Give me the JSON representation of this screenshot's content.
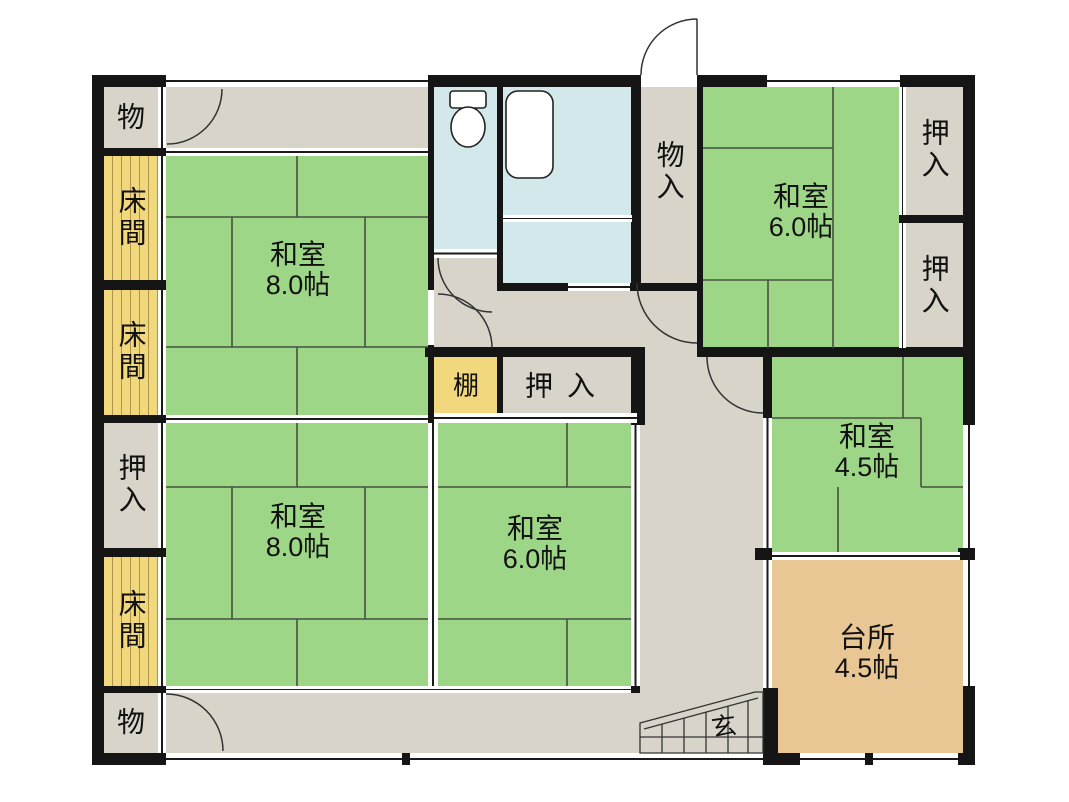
{
  "plan": {
    "type": "japanese-house-floor-plan",
    "colors": {
      "tatami_green": "#9ed687",
      "hall_gray": "#d8d4c9",
      "tokonoma_yellow": "#f2d87c",
      "wet_area_blue": "#d2e8ea",
      "kitchen_tan": "#e9c795",
      "wall_black": "#151515"
    },
    "rooms": [
      {
        "id": "storage-top-left",
        "label": "物"
      },
      {
        "id": "tokonoma-upper-1",
        "label": "床間"
      },
      {
        "id": "tokonoma-upper-2",
        "label": "床間"
      },
      {
        "id": "closet-left",
        "label": "押入"
      },
      {
        "id": "tokonoma-lower",
        "label": "床間"
      },
      {
        "id": "storage-bottom-left",
        "label": "物"
      },
      {
        "id": "washitsu-8-north",
        "label": "和室",
        "size": "8.0帖"
      },
      {
        "id": "storage-center",
        "label": "物入"
      },
      {
        "id": "washitsu-6-northeast",
        "label": "和室",
        "size": "6.0帖"
      },
      {
        "id": "closet-right-upper",
        "label": "押入"
      },
      {
        "id": "closet-right-lower",
        "label": "押入"
      },
      {
        "id": "washitsu-45-east",
        "label": "和室",
        "size": "4.5帖"
      },
      {
        "id": "kitchen",
        "label": "台所",
        "size": "4.5帖"
      },
      {
        "id": "shelf",
        "label": "棚"
      },
      {
        "id": "closet-center",
        "label": "押入"
      },
      {
        "id": "washitsu-8-south",
        "label": "和室",
        "size": "8.0帖"
      },
      {
        "id": "washitsu-6-south",
        "label": "和室",
        "size": "6.0帖"
      },
      {
        "id": "entrance-genkan",
        "label": "玄"
      }
    ]
  }
}
